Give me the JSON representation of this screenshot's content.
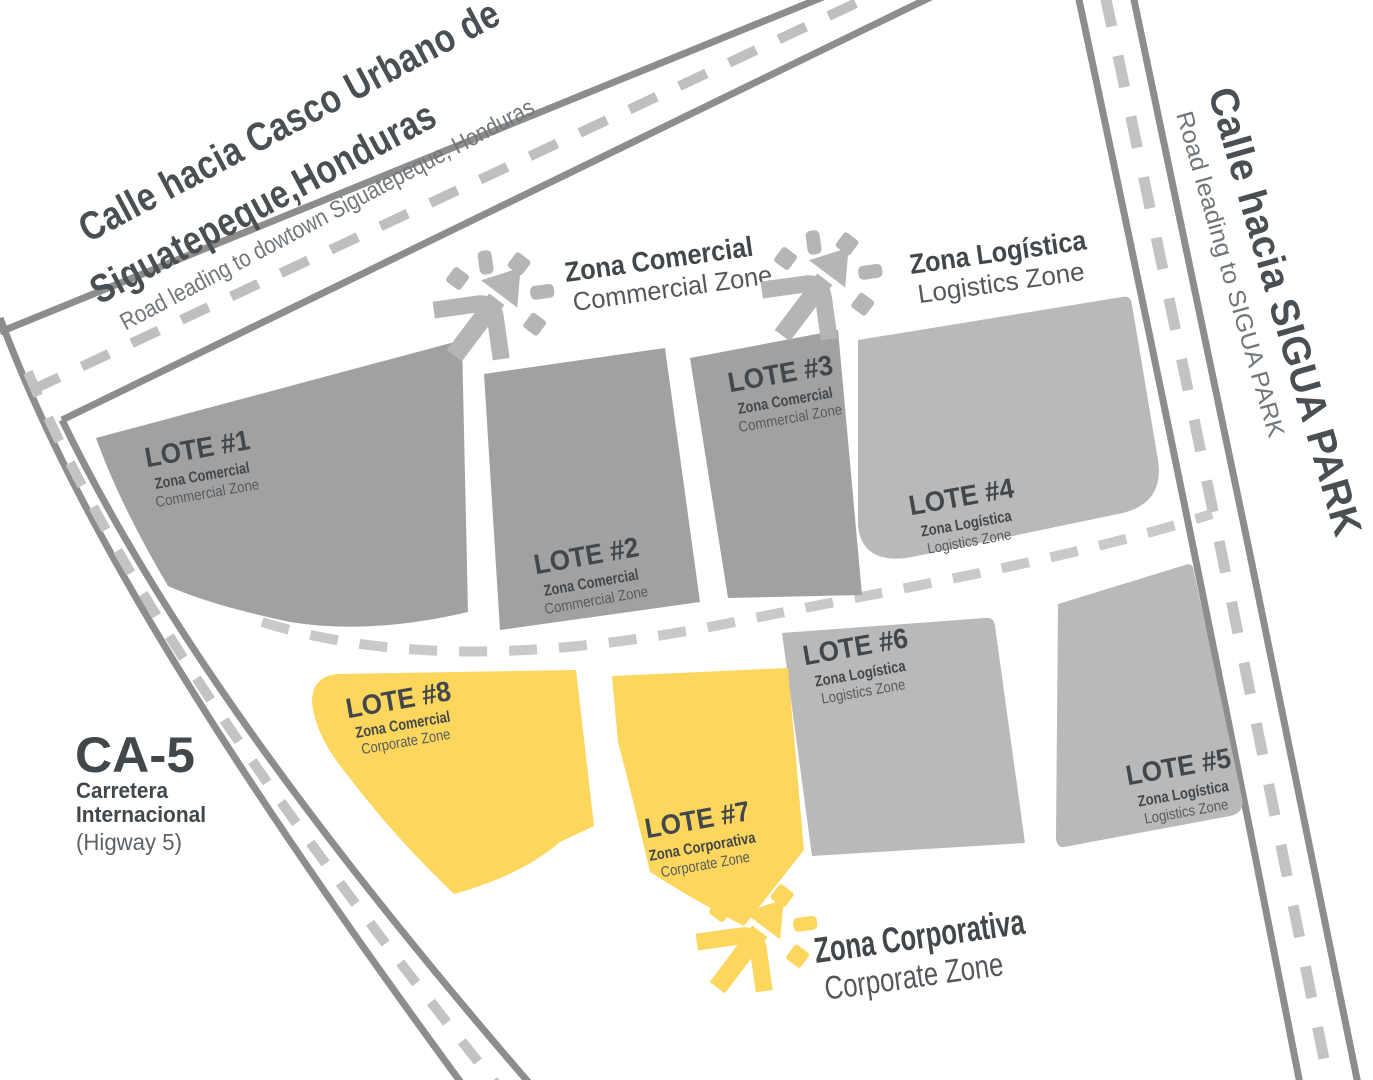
{
  "header_road": {
    "line1": "Calle hacia Casco Urbano de",
    "line2": "Siguatepeque,Honduras",
    "subtitle": "Road leading to dowtown Siguatepeque, Honduras"
  },
  "sigua_road": {
    "title": "Calle hacia SIGUA PARK",
    "subtitle": "Road leading to SIGUA PARK"
  },
  "highway": {
    "code": "CA-5",
    "name_line1": "Carretera",
    "name_line2": "Internacional",
    "name_en": "(Higway 5)"
  },
  "legends": [
    {
      "id": "comercial",
      "title": "Zona Comercial",
      "subtitle": "Commercial Zone",
      "icon": "sunburst-arrow-icon",
      "color": "#b5b5b5"
    },
    {
      "id": "logistica",
      "title": "Zona Logística",
      "subtitle": "Logistics Zone",
      "icon": "sunburst-arrow-icon",
      "color": "#b5b5b5"
    },
    {
      "id": "corporativa",
      "title": "Zona Corporativa",
      "subtitle": "Corporate Zone",
      "icon": "sunburst-arrow-icon",
      "color": "#fcd65d"
    }
  ],
  "lots": [
    {
      "name": "LOTE #1",
      "zone": "Zona Comercial",
      "zone_en": "Commercial Zone",
      "fill": "#a1a1a1"
    },
    {
      "name": "LOTE #2",
      "zone": "Zona Comercial",
      "zone_en": "Commercial Zone",
      "fill": "#a1a1a1"
    },
    {
      "name": "LOTE #3",
      "zone": "Zona Comercial",
      "zone_en": "Commercial Zone",
      "fill": "#a1a1a1"
    },
    {
      "name": "LOTE #4",
      "zone": "Zona Logística",
      "zone_en": "Logistics Zone",
      "fill": "#b9b9b9"
    },
    {
      "name": "LOTE #5",
      "zone": "Zona Logística",
      "zone_en": "Logistics Zone",
      "fill": "#b9b9b9"
    },
    {
      "name": "LOTE #6",
      "zone": "Zona Logística",
      "zone_en": "Logistics Zone",
      "fill": "#b9b9b9"
    },
    {
      "name": "LOTE #7",
      "zone": "Zona Corporativa",
      "zone_en": "Corporate Zone",
      "fill": "#fcd65d"
    },
    {
      "name": "LOTE #8",
      "zone": "Zona Comercial",
      "zone_en": "Corporate Zone",
      "fill": "#fcd65d"
    }
  ],
  "colors": {
    "road_edge": "#8d8d8d",
    "road_dash": "#c3c3c3",
    "lot_commercial": "#a1a1a1",
    "lot_logistics": "#b9b9b9",
    "lot_corporate": "#fcd65d",
    "text_dark": "#42474b",
    "text_muted": "#565b5f"
  }
}
